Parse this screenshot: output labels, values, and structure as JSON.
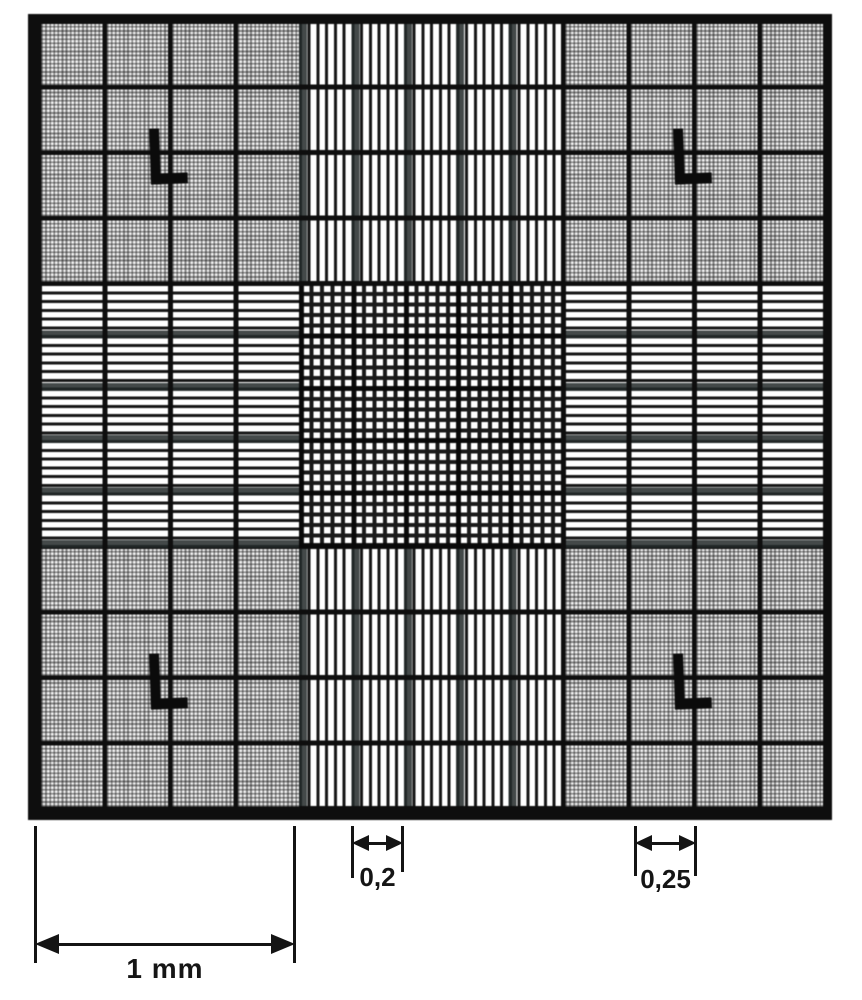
{
  "figure": {
    "type": "hemocytometer-counting-chamber-grid",
    "dimensions": {
      "square_width": {
        "label": "1 mm"
      },
      "group_width": {
        "label": "0,2"
      },
      "cell_width": {
        "label": "0,25"
      }
    },
    "corner_mark": {
      "glyph": "L"
    },
    "colors": {
      "ink": "#0e0e0e",
      "paper": "#ffffff",
      "halftone_gray": "#8f8f8f"
    }
  }
}
